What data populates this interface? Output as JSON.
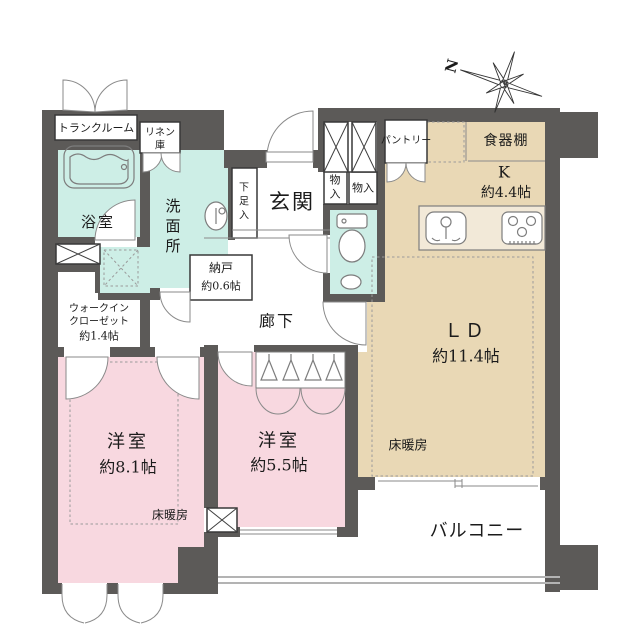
{
  "plan": {
    "type": "apartment-floor-plan",
    "colors": {
      "wall": "#5c5a58",
      "wet_area": "#cdeee6",
      "living_area": "#e9d8b5",
      "bedroom": "#f8d8e0",
      "background": "#ffffff"
    },
    "compass": {
      "label": "N"
    },
    "rooms": {
      "trunk": "トランクルーム",
      "linen1": "リネン",
      "linen2": "庫",
      "bath": "浴室",
      "wash1": "洗",
      "wash2": "面",
      "wash3": "所",
      "shoe1": "下",
      "shoe2": "足",
      "shoe3": "入",
      "genkan": "玄関",
      "nando_name": "納戸",
      "nando_size": "約0.6帖",
      "hall": "廊下",
      "mono1a": "物",
      "mono1b": "入",
      "mono2": "物入",
      "pantry": "パントリー",
      "cupboard": "食器棚",
      "kitchen": "K",
      "kitchen_size": "約4.4帖",
      "ld": "ＬＤ",
      "ld_size": "約11.4帖",
      "heating": "床暖房",
      "wic1": "ウォークイン",
      "wic2": "クローゼット",
      "wic3": "約1.4帖",
      "bed1": "洋室",
      "bed1_size": "約8.1帖",
      "bed2": "洋室",
      "bed2_size": "約5.5帖",
      "balcony": "バルコニー"
    }
  }
}
